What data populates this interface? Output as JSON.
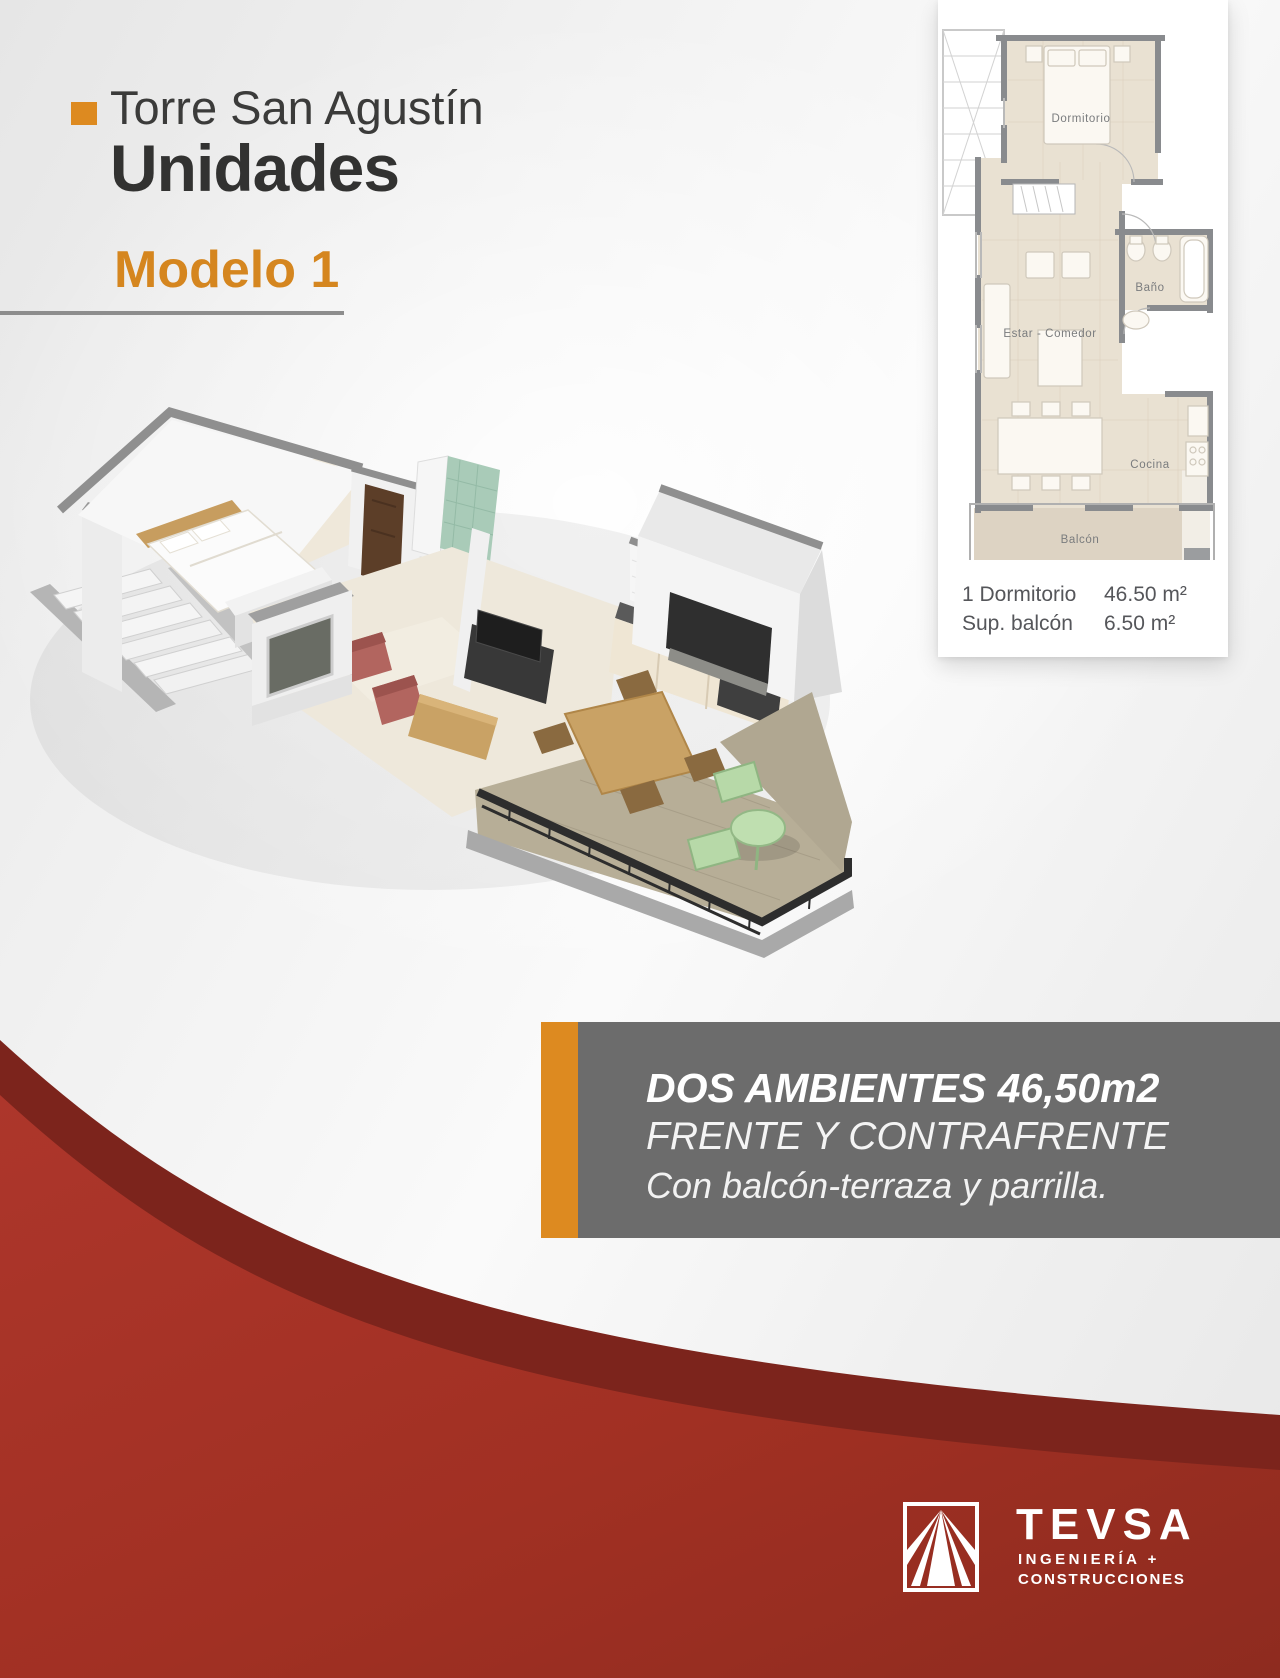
{
  "header": {
    "project": "Torre San Agustín",
    "section": "Unidades",
    "model": "Modelo 1"
  },
  "floorplan_card": {
    "rooms": {
      "bedroom": "Dormitorio",
      "bath": "Baño",
      "living": "Estar - Comedor",
      "kitchen": "Cocina",
      "balcony": "Balcón"
    },
    "stats": [
      {
        "label": "1 Dormitorio",
        "value": "46.50 m²"
      },
      {
        "label": "Sup. balcón",
        "value": "6.50 m²"
      }
    ]
  },
  "description_panel": {
    "line1": "DOS AMBIENTES 46,50m2",
    "line2": "FRENTE Y CONTRAFRENTE",
    "line3": "Con balcón-terraza y parrilla."
  },
  "footer": {
    "brand": "TEVSA",
    "tagline_line1": "INGENIERÍA +",
    "tagline_line2": "CONSTRUCCIONES"
  },
  "colors": {
    "accent_orange": "#DD8A20",
    "red_bright": "#A8352A",
    "red_dark": "#7C241C",
    "panel_gray": "#6C6C6C",
    "text_dark": "#3B3B3A"
  }
}
